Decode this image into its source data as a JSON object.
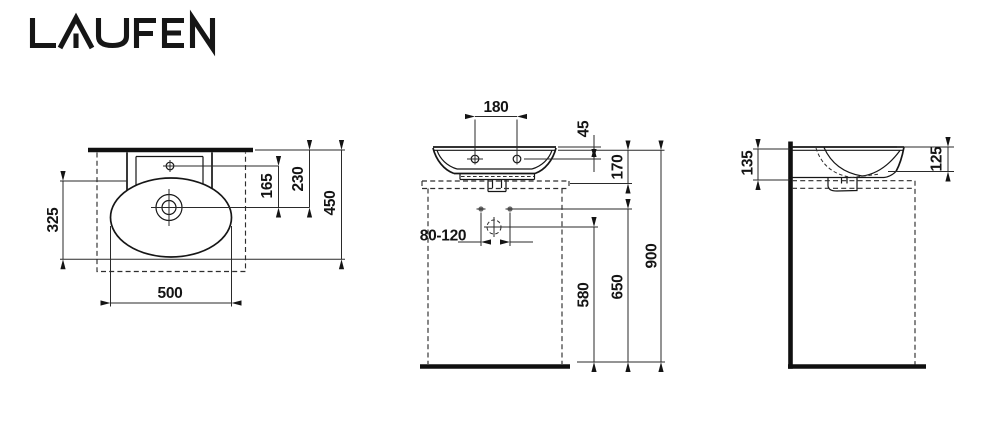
{
  "brand": {
    "logo": "LAUFEN"
  },
  "drawing": {
    "top_view": {
      "dims": {
        "left_depth": "325",
        "bowl_width": "500",
        "tap_to_drain": "165",
        "wall_to_drain": "230",
        "overall_depth": "450"
      }
    },
    "front_view": {
      "dims": {
        "tap_hole_spacing": "180",
        "rim_to_tap": "45",
        "bowl_height": "170",
        "outlet_spacing": "80-120",
        "drain_height": "580",
        "fixing_height": "650",
        "rim_height": "900"
      }
    },
    "side_view": {
      "dims": {
        "back_height": "135",
        "front_height": "125"
      }
    }
  }
}
